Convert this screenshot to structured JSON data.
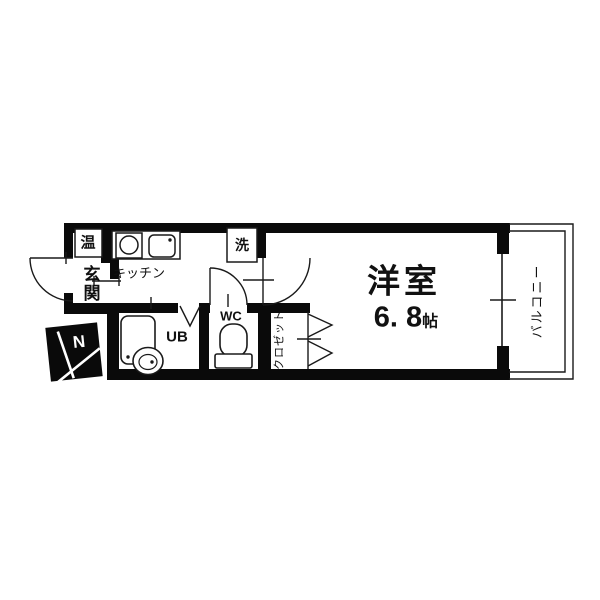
{
  "floorplan": {
    "rooms": {
      "water_heater": "温",
      "entrance": "玄関",
      "kitchen": "キッチン",
      "laundry": "洗",
      "unit_bath": "UB",
      "toilet": "WC",
      "closet": "クロゼット",
      "main_room": "洋室",
      "main_room_size": "6. 8",
      "main_room_size_unit": "帖",
      "balcony": "バルコニー"
    },
    "compass": {
      "north_label": "N"
    },
    "colors": {
      "wall": "#0a0a0a",
      "line": "#1a1a1a",
      "background": "#ffffff"
    }
  }
}
